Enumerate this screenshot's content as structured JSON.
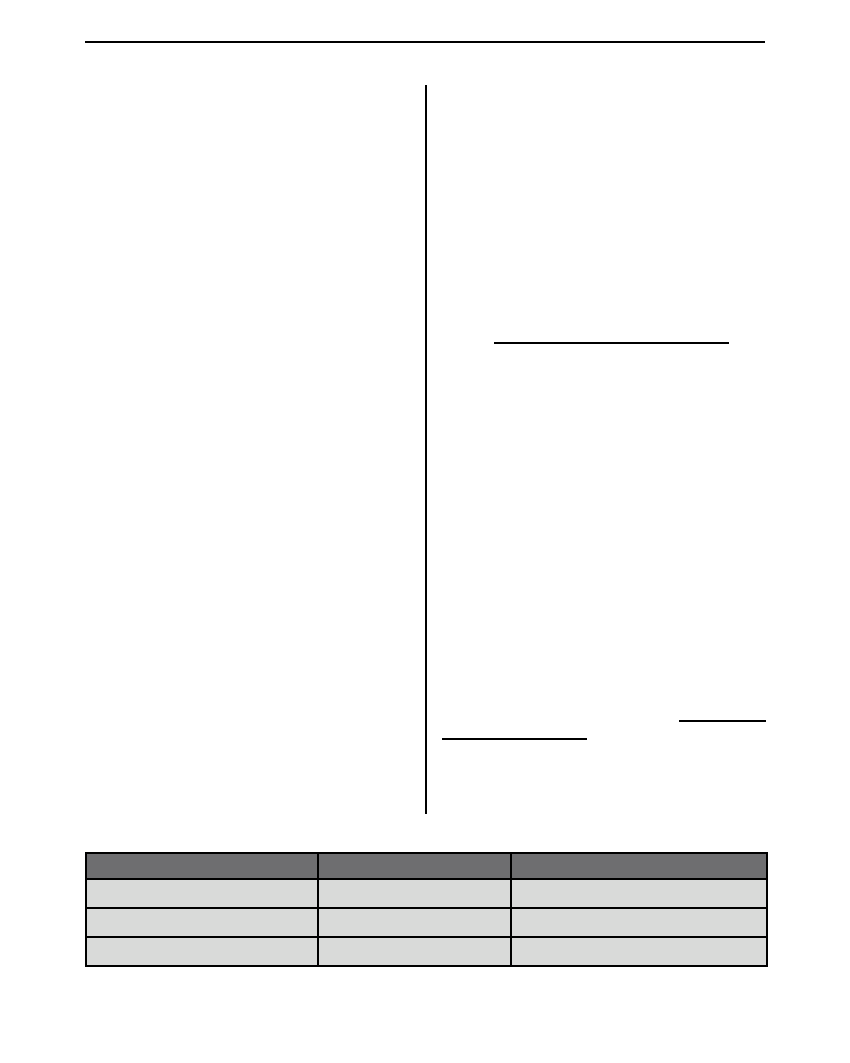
{
  "colors": {
    "page-bg": "#ffffff",
    "rule-color": "#000000",
    "table-border-color": "#000000",
    "table-header-bg": "#6e6e70",
    "table-row-bg": "#d9dad9"
  },
  "table": {
    "columns": [
      "",
      "",
      ""
    ],
    "rows": [
      [
        "",
        "",
        ""
      ],
      [
        "",
        "",
        ""
      ],
      [
        "",
        "",
        ""
      ]
    ]
  }
}
